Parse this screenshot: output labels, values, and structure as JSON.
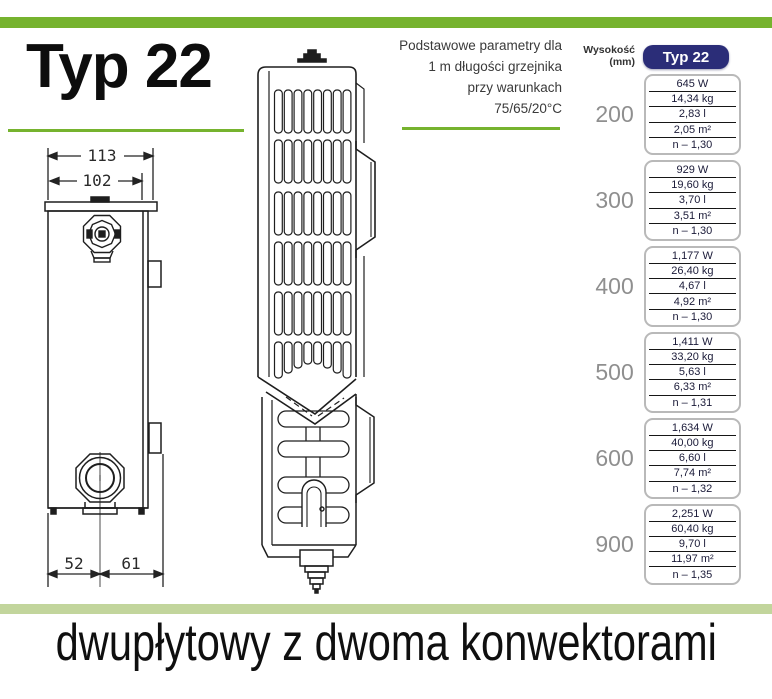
{
  "header": {
    "title": "Typ 22",
    "params_note_lines": [
      "Podstawowe parametry dla",
      "1 m długości grzejnika",
      "przy warunkach",
      "75/65/20°C"
    ]
  },
  "drawing": {
    "dim_top_outer": "113",
    "dim_top_inner": "102",
    "dim_bottom_left": "52",
    "dim_bottom_right": "61"
  },
  "table": {
    "col_height_label": "Wysokość (mm)",
    "col_type_label": "Typ 22",
    "rows": [
      {
        "height": "200",
        "values": [
          "645 W",
          "14,34 kg",
          "2,83 l",
          "2,05 m²",
          "n – 1,30"
        ]
      },
      {
        "height": "300",
        "values": [
          "929 W",
          "19,60 kg",
          "3,70 l",
          "3,51 m²",
          "n – 1,30"
        ]
      },
      {
        "height": "400",
        "values": [
          "1,177 W",
          "26,40 kg",
          "4,67 l",
          "4,92 m²",
          "n – 1,30"
        ]
      },
      {
        "height": "500",
        "values": [
          "1,411 W",
          "33,20 kg",
          "5,63 l",
          "6,33 m²",
          "n – 1,31"
        ]
      },
      {
        "height": "600",
        "values": [
          "1,634 W",
          "40,00 kg",
          "6,60 l",
          "7,74 m²",
          "n – 1,32"
        ]
      },
      {
        "height": "900",
        "values": [
          "2,251 W",
          "60,40 kg",
          "9,70 l",
          "11,97 m²",
          "n – 1,35"
        ]
      }
    ]
  },
  "footer": {
    "caption": "dwupłytowy z dwoma konwektorami"
  },
  "colors": {
    "accent_green": "#76b32e",
    "pale_green": "#c2d59c",
    "navy": "#2b2d78",
    "gray_label": "#8f8f8f"
  }
}
